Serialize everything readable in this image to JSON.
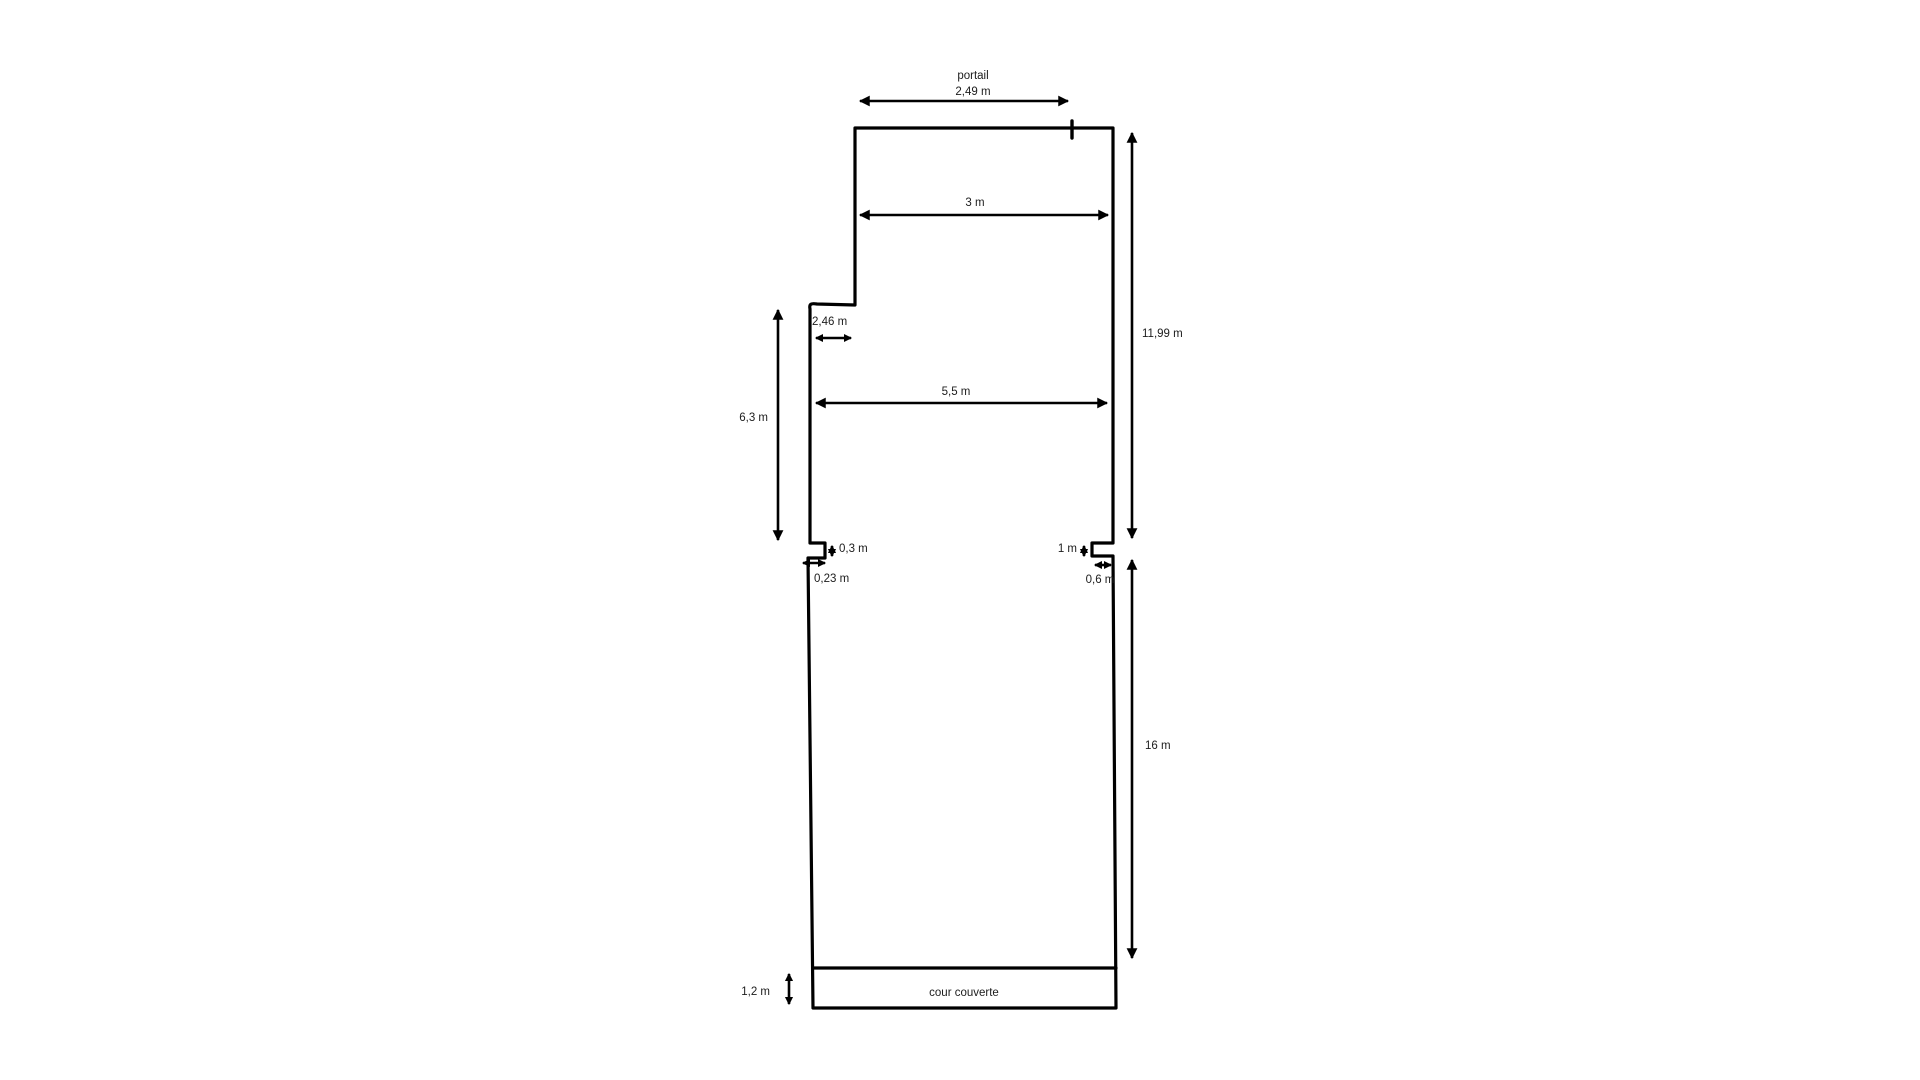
{
  "colors": {
    "line": "#000000",
    "text": "#1c1c1c",
    "background": "#ffffff"
  },
  "plan": {
    "gate": {
      "name": "portail",
      "width": "2,49 m"
    },
    "top_width": "3 m",
    "upper_right_height": "11,99 m",
    "upper_step_width": "2,46 m",
    "upper_left_height": "6,3 m",
    "middle_width": "5,5 m",
    "left_notch": {
      "height": "0,3 m",
      "width": "0,23 m"
    },
    "right_notch": {
      "height": "1 m",
      "width": "0,6 m"
    },
    "lower_right_height": "16 m",
    "covered_yard": {
      "label": "cour couverte",
      "height": "1,2 m"
    }
  }
}
